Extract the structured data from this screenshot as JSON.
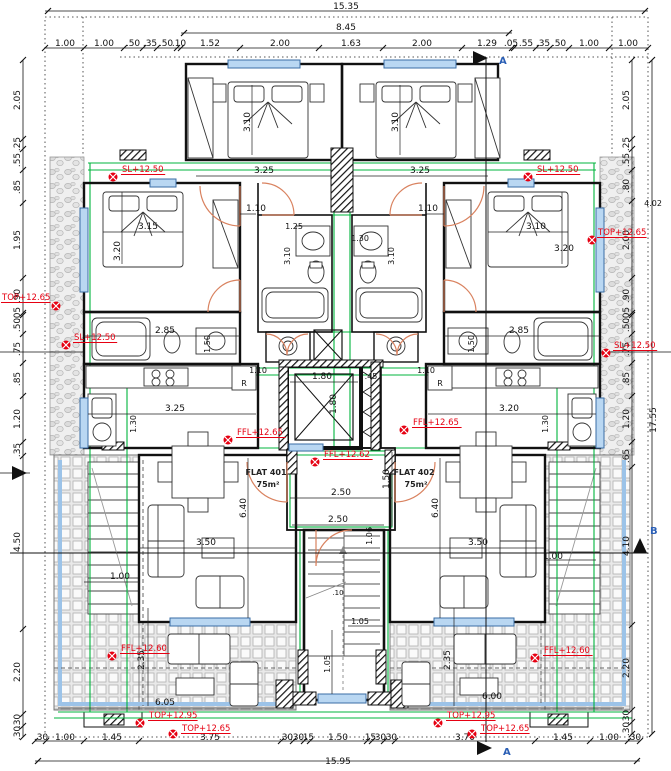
{
  "drawing": {
    "type": "floor-plan",
    "flats": [
      "FLAT 401",
      "FLAT 402"
    ]
  },
  "colors": {
    "annotation_red": "#e60012",
    "service_green": "#00b43c",
    "window_blue": "#b9d7f2",
    "door_orange": "#d9825f",
    "section_blue": "#2b5fb5"
  },
  "labels": {
    "overall": [
      {
        "t": "15.35",
        "x": 346,
        "y": 9
      },
      {
        "t": "8.45",
        "x": 346,
        "y": 30
      },
      {
        "t": "15.95",
        "x": 338,
        "y": 764
      },
      {
        "t": "17.55",
        "x": 656,
        "y": 420,
        "r": -90
      },
      {
        "t": "4.02",
        "x": 653,
        "y": 206,
        "s": 8
      }
    ],
    "top": [
      {
        "t": "1.00",
        "x": 65,
        "y": 46
      },
      {
        "t": "1.00",
        "x": 104,
        "y": 46
      },
      {
        "t": ".50",
        "x": 133,
        "y": 46
      },
      {
        "t": ".35",
        "x": 150,
        "y": 46
      },
      {
        "t": ".50",
        "x": 166,
        "y": 46
      },
      {
        "t": ".10",
        "x": 179,
        "y": 46
      },
      {
        "t": "1.52",
        "x": 210,
        "y": 46
      },
      {
        "t": "2.00",
        "x": 280,
        "y": 46
      },
      {
        "t": "1.63",
        "x": 351,
        "y": 46
      },
      {
        "t": "2.00",
        "x": 422,
        "y": 46
      },
      {
        "t": "1.29",
        "x": 487,
        "y": 46
      },
      {
        "t": ".05",
        "x": 511,
        "y": 46
      },
      {
        "t": ".55",
        "x": 526,
        "y": 46
      },
      {
        "t": ".35",
        "x": 543,
        "y": 46
      },
      {
        "t": ".50",
        "x": 559,
        "y": 46
      },
      {
        "t": "1.00",
        "x": 589,
        "y": 46
      },
      {
        "t": "1.00",
        "x": 628,
        "y": 46
      }
    ],
    "bottom": [
      {
        "t": ".30",
        "x": 41,
        "y": 740
      },
      {
        "t": "1.00",
        "x": 65,
        "y": 740
      },
      {
        "t": "1.45",
        "x": 112,
        "y": 740
      },
      {
        "t": "3.75",
        "x": 210,
        "y": 740
      },
      {
        "t": ".30",
        "x": 286,
        "y": 740
      },
      {
        "t": ".30",
        "x": 297,
        "y": 740
      },
      {
        "t": ".15",
        "x": 307,
        "y": 740
      },
      {
        "t": "1.50",
        "x": 338,
        "y": 740
      },
      {
        "t": ".15",
        "x": 369,
        "y": 740
      },
      {
        "t": ".30",
        "x": 379,
        "y": 740
      },
      {
        "t": ".30",
        "x": 390,
        "y": 740
      },
      {
        "t": "3.70",
        "x": 465,
        "y": 740
      },
      {
        "t": "1.45",
        "x": 563,
        "y": 740
      },
      {
        "t": "1.00",
        "x": 609,
        "y": 740
      },
      {
        "t": ".30",
        "x": 634,
        "y": 740
      }
    ],
    "left": [
      {
        "t": "2.05",
        "x": 20,
        "y": 100,
        "r": -90
      },
      {
        "t": ".25",
        "x": 20,
        "y": 144,
        "r": -90
      },
      {
        "t": ".55",
        "x": 20,
        "y": 160,
        "r": -90
      },
      {
        "t": ".85",
        "x": 20,
        "y": 187,
        "r": -90
      },
      {
        "t": "1.95",
        "x": 20,
        "y": 240,
        "r": -90
      },
      {
        "t": ".90",
        "x": 20,
        "y": 296,
        "r": -90
      },
      {
        "t": ".05",
        "x": 20,
        "y": 314,
        "r": -90
      },
      {
        "t": ".50",
        "x": 20,
        "y": 325,
        "r": -90
      },
      {
        "t": ".75",
        "x": 20,
        "y": 349,
        "r": -90
      },
      {
        "t": ".85",
        "x": 20,
        "y": 379,
        "r": -90
      },
      {
        "t": "1.20",
        "x": 20,
        "y": 419,
        "r": -90
      },
      {
        "t": ".35",
        "x": 20,
        "y": 450,
        "r": -90
      },
      {
        "t": "4.50",
        "x": 20,
        "y": 542,
        "r": -90
      },
      {
        "t": "2.20",
        "x": 20,
        "y": 672,
        "r": -90
      },
      {
        "t": ".30",
        "x": 20,
        "y": 721,
        "r": -90
      },
      {
        "t": ".30",
        "x": 20,
        "y": 733,
        "r": -90
      }
    ],
    "right": [
      {
        "t": "2.05",
        "x": 629,
        "y": 100,
        "r": -90
      },
      {
        "t": ".25",
        "x": 629,
        "y": 144,
        "r": -90
      },
      {
        "t": ".55",
        "x": 629,
        "y": 160,
        "r": -90
      },
      {
        "t": ".80",
        "x": 629,
        "y": 186,
        "r": -90
      },
      {
        "t": "2.00",
        "x": 629,
        "y": 240,
        "r": -90
      },
      {
        "t": ".90",
        "x": 629,
        "y": 296,
        "r": -90
      },
      {
        "t": ".05",
        "x": 629,
        "y": 314,
        "r": -90
      },
      {
        "t": ".50",
        "x": 629,
        "y": 325,
        "r": -90
      },
      {
        "t": ".75",
        "x": 629,
        "y": 349,
        "r": -90
      },
      {
        "t": ".85",
        "x": 629,
        "y": 379,
        "r": -90
      },
      {
        "t": "1.20",
        "x": 629,
        "y": 419,
        "r": -90
      },
      {
        "t": ".65",
        "x": 629,
        "y": 456,
        "r": -90
      },
      {
        "t": "4.10",
        "x": 629,
        "y": 546,
        "r": -90
      },
      {
        "t": "2.20",
        "x": 629,
        "y": 668,
        "r": -90
      },
      {
        "t": ".30",
        "x": 629,
        "y": 717,
        "r": -90
      },
      {
        "t": ".30",
        "x": 629,
        "y": 729,
        "r": -90
      }
    ],
    "interior": [
      {
        "t": "3.10",
        "x": 250,
        "y": 122,
        "r": -90
      },
      {
        "t": "3.10",
        "x": 398,
        "y": 122,
        "r": -90
      },
      {
        "t": "3.25",
        "x": 264,
        "y": 173
      },
      {
        "t": "3.25",
        "x": 420,
        "y": 173
      },
      {
        "t": "1.10",
        "x": 256,
        "y": 211
      },
      {
        "t": "1.10",
        "x": 428,
        "y": 211
      },
      {
        "t": "1.25",
        "x": 294,
        "y": 229,
        "s": 8
      },
      {
        "t": "1.30",
        "x": 360,
        "y": 241,
        "s": 8
      },
      {
        "t": "3.10",
        "x": 290,
        "y": 256,
        "r": -90,
        "s": 8
      },
      {
        "t": "3.10",
        "x": 394,
        "y": 256,
        "r": -90,
        "s": 8
      },
      {
        "t": "3.15",
        "x": 148,
        "y": 229
      },
      {
        "t": "3.10",
        "x": 536,
        "y": 229
      },
      {
        "t": "3.20",
        "x": 120,
        "y": 251,
        "r": -90
      },
      {
        "t": "3.20",
        "x": 564,
        "y": 251
      },
      {
        "t": "2.85",
        "x": 165,
        "y": 333
      },
      {
        "t": "2.85",
        "x": 519,
        "y": 333
      },
      {
        "t": "1.50",
        "x": 210,
        "y": 344,
        "r": -90,
        "s": 8
      },
      {
        "t": "1.50",
        "x": 474,
        "y": 344,
        "r": -90,
        "s": 8
      },
      {
        "t": "1.10",
        "x": 258,
        "y": 373,
        "s": 8
      },
      {
        "t": "1.10",
        "x": 426,
        "y": 373,
        "s": 8
      },
      {
        "t": "1.80",
        "x": 322,
        "y": 379
      },
      {
        "t": ".45",
        "x": 371,
        "y": 379,
        "s": 8
      },
      {
        "t": "1.80",
        "x": 336,
        "y": 404,
        "r": -90
      },
      {
        "t": "3.25",
        "x": 175,
        "y": 411
      },
      {
        "t": "3.20",
        "x": 509,
        "y": 411
      },
      {
        "t": "1.30",
        "x": 136,
        "y": 424,
        "r": -90,
        "s": 8
      },
      {
        "t": "1.30",
        "x": 548,
        "y": 424,
        "r": -90,
        "s": 8
      },
      {
        "t": "R",
        "x": 244,
        "y": 386,
        "s": 8
      },
      {
        "t": "R",
        "x": 440,
        "y": 386,
        "s": 8
      },
      {
        "t": "1.50",
        "x": 389,
        "y": 479,
        "r": -90
      },
      {
        "t": "2.50",
        "x": 341,
        "y": 495
      },
      {
        "t": "2.50",
        "x": 338,
        "y": 522
      },
      {
        "t": "6.40",
        "x": 246,
        "y": 508,
        "r": -90
      },
      {
        "t": "6.40",
        "x": 438,
        "y": 508,
        "r": -90
      },
      {
        "t": "3.50",
        "x": 206,
        "y": 545
      },
      {
        "t": "3.50",
        "x": 478,
        "y": 545
      },
      {
        "t": "1.00",
        "x": 120,
        "y": 579
      },
      {
        "t": "1.00",
        "x": 553,
        "y": 559
      },
      {
        "t": "1.06",
        "x": 372,
        "y": 536,
        "r": -90,
        "s": 8
      },
      {
        "t": ".10",
        "x": 338,
        "y": 595,
        "s": 7
      },
      {
        "t": "1.05",
        "x": 360,
        "y": 624,
        "s": 8
      },
      {
        "t": "1.05",
        "x": 330,
        "y": 664,
        "r": -90,
        "s": 8
      },
      {
        "t": "2.35",
        "x": 144,
        "y": 660,
        "r": -90
      },
      {
        "t": "2.35",
        "x": 450,
        "y": 660,
        "r": -90
      },
      {
        "t": "6.05",
        "x": 165,
        "y": 705
      },
      {
        "t": "6.00",
        "x": 492,
        "y": 699
      }
    ],
    "rooms": [
      {
        "t": "FLAT 401",
        "x": 266,
        "y": 475,
        "s": 8
      },
      {
        "t": "75m²",
        "x": 268,
        "y": 487,
        "s": 8
      },
      {
        "t": "FLAT 402",
        "x": 414,
        "y": 475,
        "s": 8
      },
      {
        "t": "75m²",
        "x": 416,
        "y": 487,
        "s": 8
      }
    ]
  },
  "red_markers": [
    {
      "t": "SL+12.50",
      "x": 113,
      "y": 177,
      "tx": 122,
      "ty": 172
    },
    {
      "t": "SL+12.50",
      "x": 528,
      "y": 177,
      "tx": 537,
      "ty": 172
    },
    {
      "t": "TOP+12.65",
      "x": 592,
      "y": 240,
      "tx": 598,
      "ty": 235
    },
    {
      "t": "TOP+12.65",
      "x": 56,
      "y": 306,
      "tx": 2,
      "ty": 300
    },
    {
      "t": "SL+12.50",
      "x": 66,
      "y": 345,
      "tx": 74,
      "ty": 340
    },
    {
      "t": "SL+12.50",
      "x": 606,
      "y": 353,
      "tx": 614,
      "ty": 348
    },
    {
      "t": "FFL+12.65",
      "x": 228,
      "y": 440,
      "tx": 237,
      "ty": 435
    },
    {
      "t": "FFL+12.65",
      "x": 404,
      "y": 430,
      "tx": 413,
      "ty": 425
    },
    {
      "t": "FFL+12.62",
      "x": 315,
      "y": 462,
      "tx": 324,
      "ty": 457
    },
    {
      "t": "FFL+12.60",
      "x": 112,
      "y": 656,
      "tx": 121,
      "ty": 651
    },
    {
      "t": "FFL+12.60",
      "x": 535,
      "y": 658,
      "tx": 544,
      "ty": 653
    },
    {
      "t": "TOP+12.95",
      "x": 140,
      "y": 723,
      "tx": 149,
      "ty": 718
    },
    {
      "t": "TOP+12.65",
      "x": 173,
      "y": 734,
      "tx": 182,
      "ty": 731
    },
    {
      "t": "TOP+12.95",
      "x": 438,
      "y": 723,
      "tx": 447,
      "ty": 718
    },
    {
      "t": "TOP+12.65",
      "x": 472,
      "y": 734,
      "tx": 481,
      "ty": 731
    }
  ],
  "section_markers": [
    {
      "t": "A",
      "points": "473,51 473,65 488,58",
      "lx": 499,
      "ly": 64
    },
    {
      "t": "A",
      "points": "477,741 477,755 492,748",
      "lx": 503,
      "ly": 755
    },
    {
      "t": "B",
      "points": "633,553 647,553 640,538",
      "lx": 650,
      "ly": 534
    },
    {
      "t": "",
      "points": "12,466 12,480 27,473",
      "lx": 0,
      "ly": 0
    }
  ]
}
